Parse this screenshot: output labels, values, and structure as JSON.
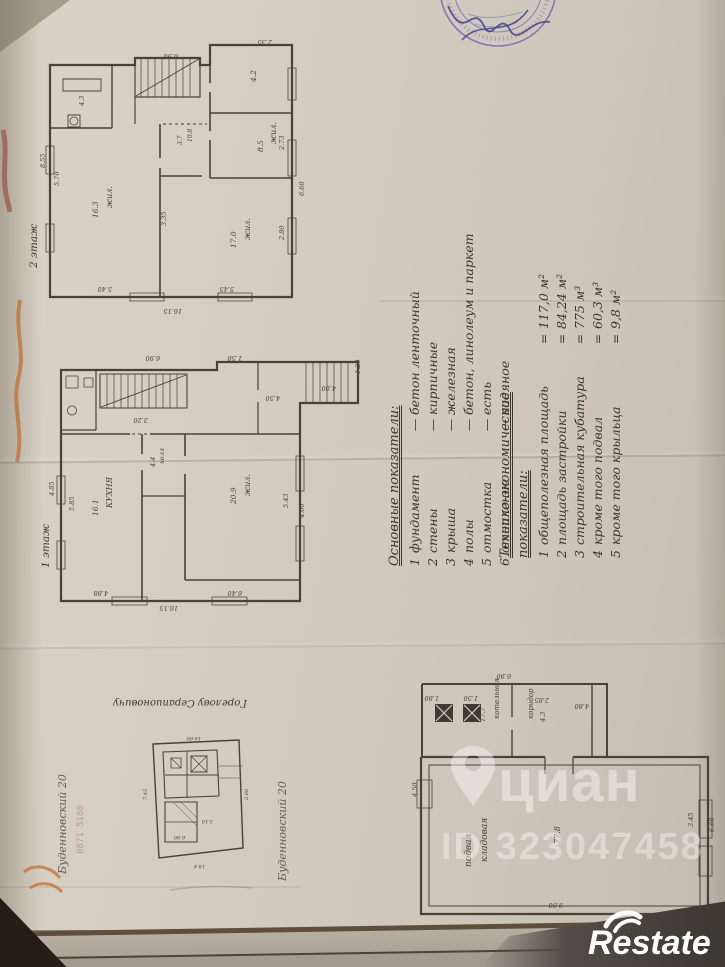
{
  "page": {
    "ink": "#474338",
    "paper_color": "#d3ccc0",
    "stamp_color": "#6b67ac",
    "signature_color": "#45408f",
    "mark_color": "#bf6b31"
  },
  "indicators_main": {
    "title": "Основные показатели:",
    "sep": "—",
    "items": [
      {
        "n": "1",
        "name": "фундамент",
        "value": "бетон ленточный"
      },
      {
        "n": "2",
        "name": "стены",
        "value": "кирпичные"
      },
      {
        "n": "3",
        "name": "крыша",
        "value": "железная"
      },
      {
        "n": "4",
        "name": "полы",
        "value": "бетон, линолеум и паркет"
      },
      {
        "n": "5",
        "name": "отмостка",
        "value": "есть"
      },
      {
        "n": "6",
        "name": "отопление",
        "value": "водяное"
      }
    ]
  },
  "indicators_tech": {
    "title": "Технико-экономические показатели:",
    "sep": "=",
    "items": [
      {
        "n": "1",
        "name": "общеполезная площадь",
        "value": "117,0 м²"
      },
      {
        "n": "2",
        "name": "площадь застройки",
        "value": "84,24 м²"
      },
      {
        "n": "3",
        "name": "строительная кубатура",
        "value": "775 м³"
      },
      {
        "n": "4",
        "name": "кроме того подвал",
        "value": "60,3 м³"
      },
      {
        "n": "5",
        "name": "кроме того крыльца",
        "value": "9,8 м²"
      }
    ]
  },
  "handwriting": {
    "site_plan_title": "Горелову Серапионовичу",
    "margin_left": "Буденновский 20",
    "margin_right": "Буденновский 20",
    "faint_digits": "0871 5180"
  },
  "watermark": {
    "brand": "циан",
    "listing_id": "ID 323047458"
  },
  "footer_logo": "Restate",
  "plans": [
    {
      "id": "floor2",
      "label": "2 этаж",
      "x": 42,
      "y": 28,
      "w": 280,
      "h": 292,
      "strokes": [
        {
          "d": "M8,37 H93 V30 H158 V37 H168 V17 H250 V269 H8 Z",
          "w": 2.2
        },
        {
          "d": "M70,37 V100 M8,100 H70",
          "w": 1.4
        },
        {
          "d": "M21,51 H59 V63 H21 Z",
          "w": 0.9
        },
        {
          "d": "M26,87 H38 V99 H26 Z",
          "w": 0.9
        },
        {
          "d": "M32,89 a4,4 0 1 1 -0.1,0",
          "w": 0.8
        },
        {
          "d": "M99,30 V69 M106,30 V69 M113,30 V69 M120,30 V69 M127,30 V69 M134,30 V69 M141,30 V69 M148,30 V69",
          "w": 0.7
        },
        {
          "d": "M93,37 V69 H158 V37",
          "w": 1.2
        },
        {
          "d": "M94,68 L157,31",
          "w": 0.9
        },
        {
          "d": "M93,69 V96",
          "w": 1.2
        },
        {
          "d": "M168,37 V55 M168,64 V103 M168,112 V150",
          "w": 1.6
        },
        {
          "d": "M168,85 H250",
          "w": 1.6
        },
        {
          "d": "M168,150 H250",
          "w": 1.6
        },
        {
          "d": "M118,96 V130 M118,140 V269",
          "w": 1.6
        },
        {
          "d": "M118,148 H160",
          "w": 1.4
        },
        {
          "d": "M121,96 H165",
          "w": 0.9,
          "dash": "3,3"
        },
        {
          "d": "M4,118 H12 V146 H4 Z M4,196 H12 V224 H4 Z",
          "w": 0.8
        },
        {
          "d": "M246,112 H254 V148 H246 Z M246,190 H254 V226 H246 Z M246,40 H254 V72 H246 Z",
          "w": 0.8
        },
        {
          "d": "M88,265 H122 V273 H88 Z M176,265 H210 V273 H176 Z",
          "w": 0.8
        }
      ],
      "texts": [
        {
          "t": "жил.",
          "x": 70,
          "y": 180,
          "s": 8
        },
        {
          "t": "16.3",
          "x": 56,
          "y": 190,
          "s": 7.5
        },
        {
          "t": "жил.",
          "x": 208,
          "y": 212,
          "s": 8
        },
        {
          "t": "17.0",
          "x": 194,
          "y": 220,
          "s": 7.5
        },
        {
          "t": "жил.",
          "x": 234,
          "y": 116,
          "s": 8
        },
        {
          "t": "8.5",
          "x": 221,
          "y": 124,
          "s": 7.5
        },
        {
          "t": "4.2",
          "x": 214,
          "y": 54,
          "s": 7.5
        },
        {
          "t": "4.3",
          "x": 42,
          "y": 78,
          "s": 6.5
        },
        {
          "t": "10.8",
          "x": 150,
          "y": 114,
          "s": 6
        },
        {
          "t": "3.7",
          "x": 140,
          "y": 117,
          "s": 6
        },
        {
          "t": "6.90",
          "x": 136,
          "y": 26,
          "r": 180,
          "s": 6.5
        },
        {
          "t": "2.35",
          "x": 230,
          "y": 12,
          "r": 180,
          "s": 6.5
        },
        {
          "t": "8.55",
          "x": 3,
          "y": 140,
          "s": 6.5
        },
        {
          "t": "5.70",
          "x": 17,
          "y": 158,
          "s": 6.5
        },
        {
          "t": "16.15",
          "x": 140,
          "y": 281,
          "r": 180,
          "s": 6.5
        },
        {
          "t": "5.40",
          "x": 70,
          "y": 259,
          "r": 180,
          "s": 6.5
        },
        {
          "t": "5.45",
          "x": 192,
          "y": 259,
          "r": 180,
          "s": 6.5
        },
        {
          "t": "3.35",
          "x": 124,
          "y": 198,
          "s": 6.5
        },
        {
          "t": "2.80",
          "x": 242,
          "y": 212,
          "s": 6.5
        },
        {
          "t": "2.73",
          "x": 242,
          "y": 122,
          "s": 6.5
        },
        {
          "t": "6.60",
          "x": 262,
          "y": 168,
          "s": 6.5
        }
      ]
    },
    {
      "id": "floor1",
      "label": "1 этаж",
      "x": 52,
      "y": 346,
      "w": 312,
      "h": 262,
      "strokes": [
        {
          "d": "M9,24 H165 V16 H306 V57 H248 V255 H9 Z",
          "w": 2.2
        },
        {
          "d": "M254,16 V57 M261,16 V57 M268,16 V57 M275,16 V57 M282,16 V57 M289,16 V57 M296,16 V57",
          "w": 0.7
        },
        {
          "d": "M206,16 V44 M206,56 V88",
          "w": 1.2
        },
        {
          "d": "M9,88 H78 M98,88 H248",
          "w": 1.6
        },
        {
          "d": "M80,88 H96",
          "w": 0.9,
          "dash": "3,3"
        },
        {
          "d": "M44,24 V84 M9,84 H44",
          "w": 1.2
        },
        {
          "d": "M14,30 H26 V42 H14 Z",
          "w": 0.8
        },
        {
          "d": "M20,60 a4.5,4.5 0 1 1 -0.1,0",
          "w": 0.8
        },
        {
          "d": "M32,32 H41 V41 H32 Z",
          "w": 0.8
        },
        {
          "d": "M48,28 H135 V62 H48 Z",
          "w": 1.1
        },
        {
          "d": "M55,28 V62 M62,28 V62 M69,28 V62 M76,28 V62 M83,28 V62 M90,28 V62 M97,28 V62 M104,28 V62 M111,28 V62 M118,28 V62 M125,28 V62",
          "w": 0.7
        },
        {
          "d": "M49,61 L134,29",
          "w": 0.9
        },
        {
          "d": "M90,88 V108 M90,124 V255",
          "w": 1.6
        },
        {
          "d": "M133,88 V110 M133,128 V234",
          "w": 1.6
        },
        {
          "d": "M90,150 H133",
          "w": 1.3
        },
        {
          "d": "M133,234 H248",
          "w": 1.6
        },
        {
          "d": "M5,130 H13 V158 H5 Z M5,195 H13 V223 H5 Z",
          "w": 0.8
        },
        {
          "d": "M244,110 H252 V145 H244 Z M244,180 H252 V215 H244 Z",
          "w": 0.8
        },
        {
          "d": "M60,251 H95 V259 H60 Z M160,251 H195 V259 H160 Z",
          "w": 0.8
        }
      ],
      "texts": [
        {
          "t": "КУХНЯ",
          "x": 60,
          "y": 162,
          "s": 8
        },
        {
          "t": "16.1",
          "x": 46,
          "y": 170,
          "s": 7.5
        },
        {
          "t": "жил.",
          "x": 198,
          "y": 150,
          "s": 8
        },
        {
          "t": "20.9",
          "x": 184,
          "y": 158,
          "s": 7.5
        },
        {
          "t": "холл",
          "x": 112,
          "y": 118,
          "s": 6.5
        },
        {
          "t": "4.4",
          "x": 103,
          "y": 121,
          "s": 6.5
        },
        {
          "t": "6.90",
          "x": 108,
          "y": 10,
          "r": 180,
          "s": 6.5
        },
        {
          "t": "1.50",
          "x": 190,
          "y": 10,
          "r": 180,
          "s": 6.5
        },
        {
          "t": "4.00",
          "x": 284,
          "y": 40,
          "r": 180,
          "s": 6.5
        },
        {
          "t": "1.20",
          "x": 308,
          "y": 28,
          "s": 6.5
        },
        {
          "t": "4.50",
          "x": 228,
          "y": 50,
          "r": 180,
          "s": 6.5
        },
        {
          "t": "3.20",
          "x": 96,
          "y": 72,
          "r": 180,
          "s": 6.5
        },
        {
          "t": "4.85",
          "x": 2,
          "y": 150,
          "s": 6.5
        },
        {
          "t": "5.85",
          "x": 22,
          "y": 165,
          "s": 6.5
        },
        {
          "t": "16.15",
          "x": 126,
          "y": 260,
          "r": 180,
          "s": 6.5
        },
        {
          "t": "6.40",
          "x": 190,
          "y": 245,
          "r": 180,
          "s": 6.5
        },
        {
          "t": "4.88",
          "x": 56,
          "y": 245,
          "r": 180,
          "s": 6.5
        },
        {
          "t": "5.43",
          "x": 236,
          "y": 162,
          "s": 6.5
        },
        {
          "t": "4.60",
          "x": 252,
          "y": 172,
          "s": 6.5
        }
      ]
    },
    {
      "id": "site",
      "label": "",
      "x": 135,
      "y": 730,
      "w": 120,
      "h": 140,
      "strokes": [
        {
          "d": "M18,14 L104,10 L108,118 L24,128 Z",
          "w": 1.4
        },
        {
          "d": "M28,22 L82,20 L84,66 L30,68 Z",
          "w": 1.1
        },
        {
          "d": "M52,21 V67",
          "w": 0.9
        },
        {
          "d": "M30,45 H84",
          "w": 0.9
        },
        {
          "d": "M56,26 H72 V42 H56 Z",
          "w": 0.9
        },
        {
          "d": "M56,26 L72,42 M72,26 L56,42",
          "w": 0.7
        },
        {
          "d": "M36,28 H46 V38 H36 Z",
          "w": 0.8
        },
        {
          "d": "M36,28 L46,38",
          "w": 0.6
        },
        {
          "d": "M30,72 H62 V112 H30 Z",
          "w": 1.1
        },
        {
          "d": "M30,92 H62",
          "w": 0.8
        },
        {
          "d": "M46,72 L62,88 M38,72 L62,96",
          "w": 0.5
        },
        {
          "d": "M84,36 H108 M84,48 H106",
          "w": 0.6
        }
      ],
      "texts": [
        {
          "t": "14.60",
          "x": 66,
          "y": 7,
          "r": 180,
          "s": 5
        },
        {
          "t": "18.4",
          "x": 70,
          "y": 135,
          "r": 180,
          "s": 5
        },
        {
          "t": "7.45",
          "x": 12,
          "y": 70,
          "s": 5
        },
        {
          "t": "2.00",
          "x": 113,
          "y": 70,
          "s": 5
        },
        {
          "t": "6.00",
          "x": 50,
          "y": 106,
          "r": 180,
          "s": 5
        },
        {
          "t": "3.10",
          "x": 78,
          "y": 90,
          "r": 180,
          "s": 5
        }
      ]
    },
    {
      "id": "basement",
      "label": "",
      "x": 415,
      "y": 662,
      "w": 302,
      "h": 270,
      "strokes": [
        {
          "d": "M6,95 H130 M158,95 H293 V252 H6 V95",
          "w": 2.2
        },
        {
          "d": "M14,103 H285 V244 H14 Z",
          "w": 1
        },
        {
          "d": "M7,22 H192 V95 M7,22 V95",
          "w": 2
        },
        {
          "d": "M97,22 V55 M97,68 V95",
          "w": 1.4
        },
        {
          "d": "M177,22 V95",
          "w": 1.4
        },
        {
          "d": "M130,95 V112 M158,95 V112",
          "w": 1.2
        },
        {
          "d": "M21,43 L37,59 M37,43 L21,59 M49,43 L65,59 M65,43 L49,59",
          "w": 1.2,
          "c": "#d6cfc3"
        },
        {
          "d": "M284,138 H297 V176 H284 Z M284,184 H297 V214 H284 Z",
          "w": 0.8
        },
        {
          "d": "M2,118 H17 V146 H2 Z",
          "w": 0.8
        }
      ],
      "fills": [
        {
          "d": "M20,42 H38 V60 H20 Z",
          "f": "#3e3a31"
        },
        {
          "d": "M48,42 H66 V60 H48 Z",
          "f": "#3e3a31"
        }
      ],
      "texts": [
        {
          "t": "котельная",
          "x": 84,
          "y": 57,
          "s": 7
        },
        {
          "t": "17.7",
          "x": 70,
          "y": 60,
          "s": 6.5
        },
        {
          "t": "коридор",
          "x": 118,
          "y": 57,
          "s": 7
        },
        {
          "t": "4.3",
          "x": 130,
          "y": 60,
          "s": 6.5
        },
        {
          "t": "подвал",
          "x": 56,
          "y": 205,
          "s": 9
        },
        {
          "t": "кладовая",
          "x": 72,
          "y": 200,
          "s": 9
        },
        {
          "t": "77.8",
          "x": 145,
          "y": 182,
          "s": 8
        },
        {
          "t": "6.90",
          "x": 96,
          "y": 12,
          "r": 180,
          "s": 6.5
        },
        {
          "t": "1.80",
          "x": 24,
          "y": 34,
          "r": 180,
          "s": 6.5
        },
        {
          "t": "1.50",
          "x": 63,
          "y": 34,
          "r": 180,
          "s": 6.5
        },
        {
          "t": "2.85",
          "x": 134,
          "y": 36,
          "r": 180,
          "s": 6.5
        },
        {
          "t": "4.80",
          "x": 174,
          "y": 42,
          "r": 180,
          "s": 6.5
        },
        {
          "t": "6.60",
          "x": 299,
          "y": 170,
          "s": 6.5
        },
        {
          "t": "3.45",
          "x": 278,
          "y": 165,
          "s": 6.5
        },
        {
          "t": "9.00",
          "x": 148,
          "y": 241,
          "r": 180,
          "s": 6.5
        },
        {
          "t": "10.15",
          "x": 158,
          "y": 264,
          "r": 180,
          "s": 6.5
        },
        {
          "t": "4.50",
          "x": 2,
          "y": 135,
          "s": 6.5
        }
      ]
    }
  ]
}
